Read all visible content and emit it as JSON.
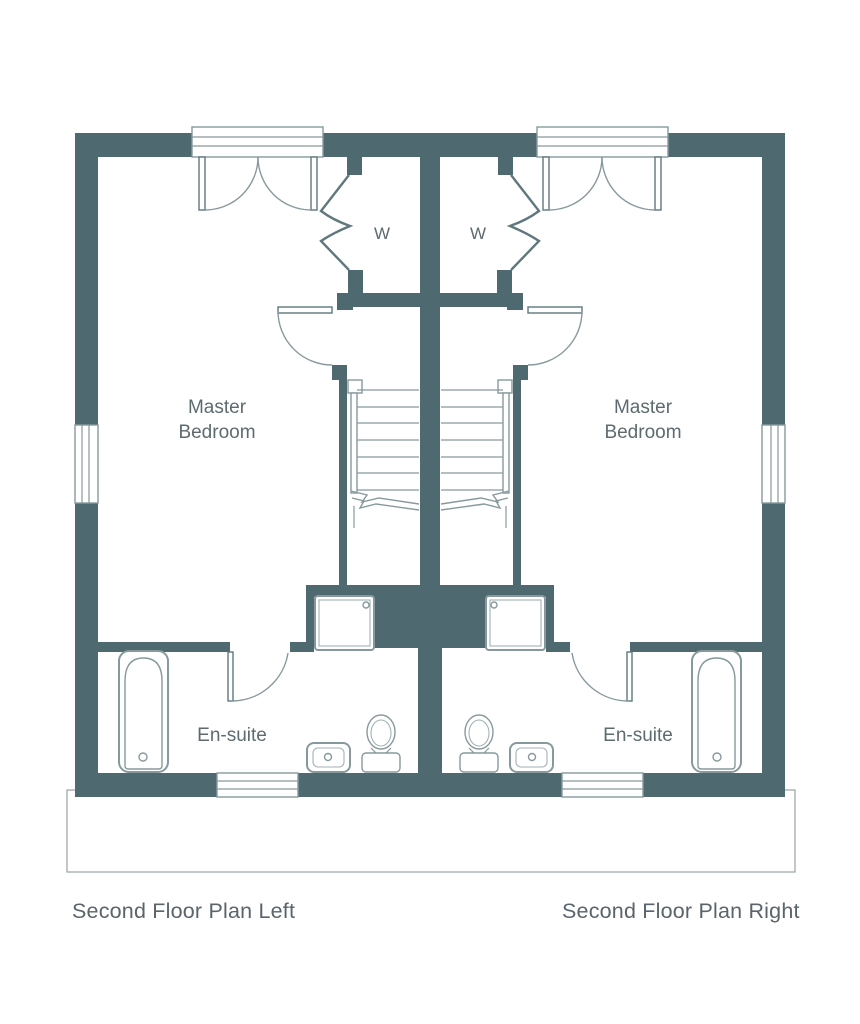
{
  "colors": {
    "wall": "#4e6a70",
    "line": "#87999d",
    "dark_line": "#5f787d",
    "light_line": "#a3b2b5",
    "label": "#5d6b70",
    "caption": "#5a646b",
    "background": "#ffffff"
  },
  "plans": {
    "left": {
      "caption": "Second Floor Plan Left",
      "master_line1": "Master",
      "master_line2": "Bedroom",
      "ensuite_label": "En-suite",
      "wardrobe_label": "W"
    },
    "right": {
      "caption": "Second Floor Plan Right",
      "master_line1": "Master",
      "master_line2": "Bedroom",
      "ensuite_label": "En-suite",
      "wardrobe_label": "W"
    }
  }
}
